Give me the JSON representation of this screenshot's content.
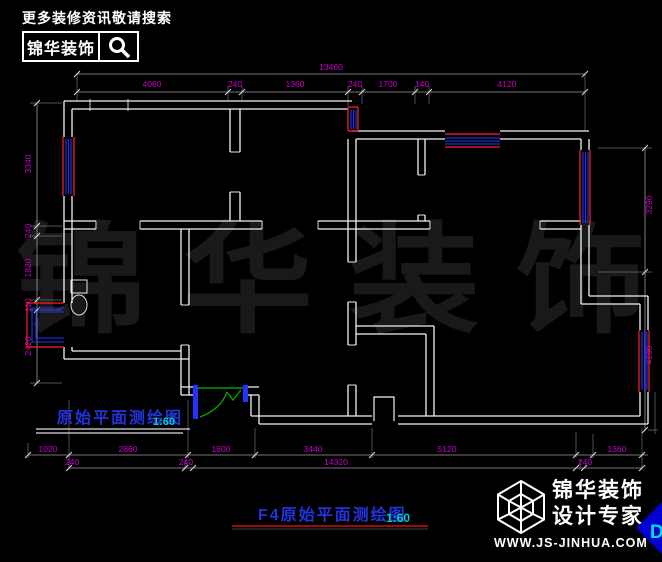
{
  "header": {
    "search_hint": "更多装修资讯敬请搜索",
    "brand": "锦华装饰"
  },
  "watermark": {
    "text": "锦 华 装 饰"
  },
  "dims": {
    "top": {
      "overall": "13460",
      "segs": [
        "4060",
        "240",
        "1360",
        "240",
        "1700",
        "140",
        "4120"
      ]
    },
    "left": {
      "segs": [
        "3340",
        "240",
        "1820",
        "110",
        "2420"
      ]
    },
    "right": {
      "segs": [
        "3290",
        "4190"
      ]
    },
    "bottom": {
      "overall": "14320",
      "row1": [
        "1020",
        "2860",
        "1800",
        "3440",
        "5120",
        "1360"
      ],
      "row2": [
        "240",
        "240",
        "240"
      ]
    }
  },
  "captions": {
    "plan_label": "原始平面测绘图",
    "plan_scale": "1:60",
    "sheet_label": "F4原始平面测绘图",
    "sheet_scale": "1:60"
  },
  "footer": {
    "brand_line1": "锦华装饰",
    "brand_line2": "设计专家",
    "url": "WWW.JS-JINHUA.COM",
    "cursor_label": "D"
  },
  "colors": {
    "background": "#000000",
    "walls": "#f2f2f2",
    "dimension_text": "#cc00cc",
    "window_red": "#ff2222",
    "window_blue": "#2233ff",
    "caption_blue": "#2233dd",
    "scale_cyan": "#00cccc",
    "door_green": "#00a000",
    "underline_red": "#cc1111",
    "logo_blue": "#0000d0",
    "watermark_gray": "#191919"
  }
}
